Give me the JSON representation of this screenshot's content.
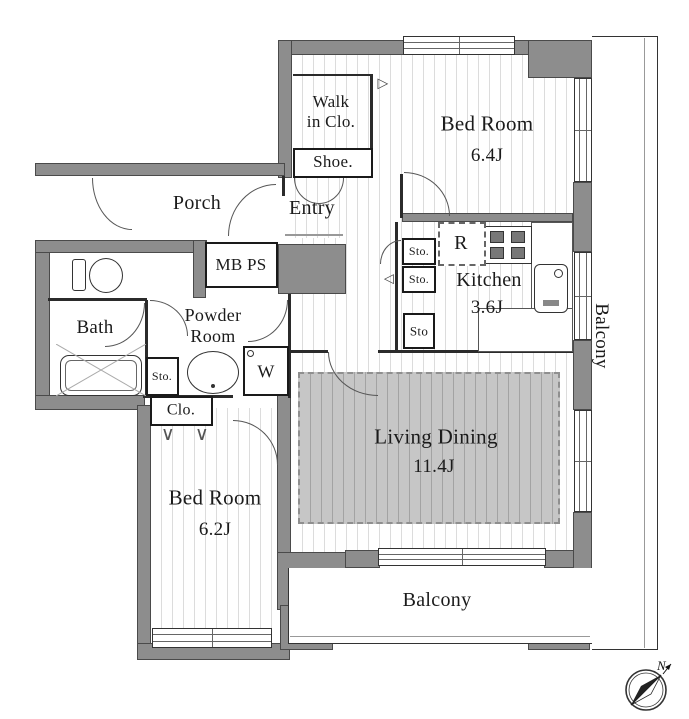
{
  "rooms": {
    "bedroom1": {
      "label": "Bed Room",
      "area": "6.4J"
    },
    "bedroom2": {
      "label": "Bed Room",
      "area": "6.2J"
    },
    "living_dining": {
      "label": "Living Dining",
      "area": "11.4J"
    },
    "kitchen": {
      "label": "Kitchen",
      "area": "3.6J"
    },
    "bath": {
      "label": "Bath"
    },
    "powder_room": {
      "line1": "Powder",
      "line2": "Room"
    },
    "entry": {
      "label": "Entry"
    },
    "porch": {
      "label": "Porch"
    },
    "walk_in_closet": {
      "line1": "Walk",
      "line2": "in Clo."
    },
    "shoe_closet": {
      "label": "Shoe."
    },
    "closet": {
      "label": "Clo."
    },
    "balcony_right": {
      "label": "Balcony"
    },
    "balcony_bottom": {
      "label": "Balcony"
    },
    "meter_pipe_space": {
      "label": "MB PS"
    }
  },
  "fixtures": {
    "refrigerator_label": "R",
    "washer_label": "W",
    "storage_bath": "Sto.",
    "storage_kitchen_1": "Sto.",
    "storage_kitchen_2": "Sto.",
    "storage_kitchen_3": "Sto",
    "compass_north": "N",
    "closet_hanger_symbol": "∨",
    "door_marker_right": "▷",
    "door_marker_left": "◁"
  },
  "colors": {
    "wall": "#8d8d8d",
    "carpet": "#c6c6c6",
    "line": "#2b2b2b"
  }
}
